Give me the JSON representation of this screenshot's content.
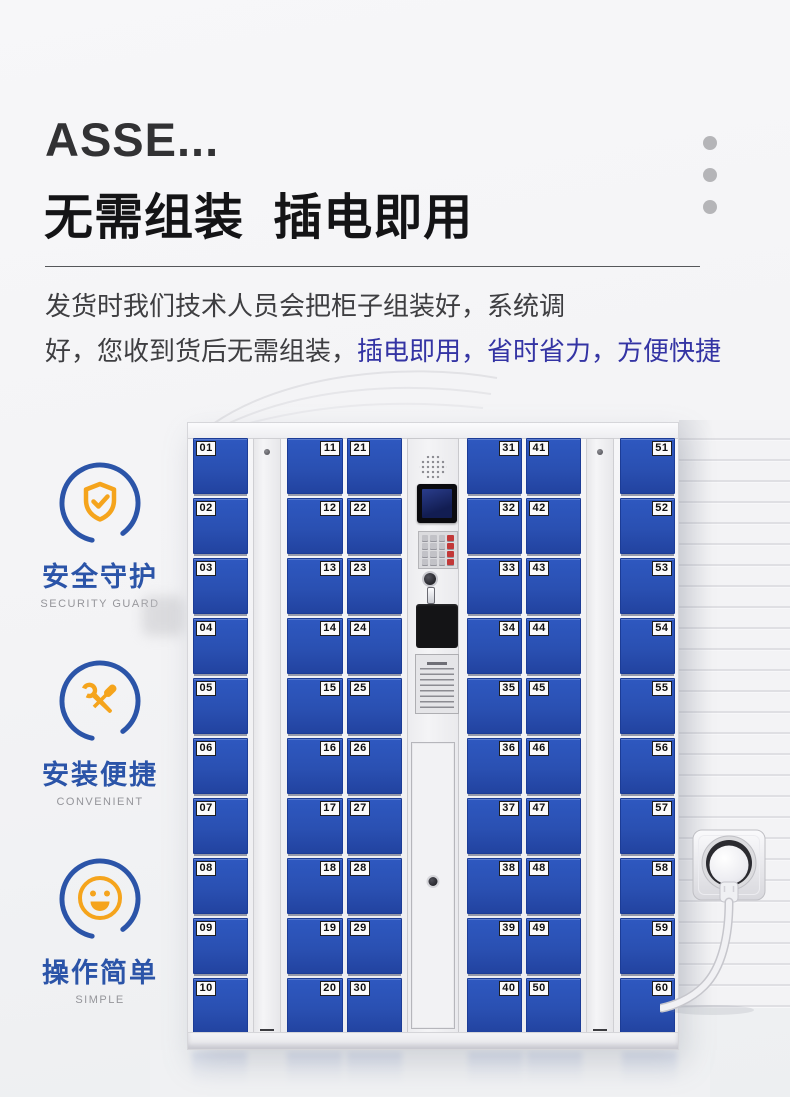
{
  "header": {
    "title_en": "ASSE...",
    "title_cn": "无需组装  插电即用",
    "description": {
      "line1": "发货时我们技术人员会把柜子组装好，系统调",
      "line2_dark": "好，您收到货后无需组装，",
      "line2_blue": "插电即用，省时省力，方便快捷"
    }
  },
  "features": [
    {
      "icon": "shield-check-icon",
      "label": "安全守护",
      "sublabel": "SECURITY GUARD"
    },
    {
      "icon": "tools-icon",
      "label": "安装便捷",
      "sublabel": "CONVENIENT"
    },
    {
      "icon": "smiley-icon",
      "label": "操作简单",
      "sublabel": "SIMPLE"
    }
  ],
  "locker": {
    "columns": [
      {
        "tag_side": "left",
        "doors": [
          "01",
          "02",
          "03",
          "04",
          "05",
          "06",
          "07",
          "08",
          "09",
          "10"
        ]
      },
      {
        "tag_side": "right",
        "doors": [
          "11",
          "12",
          "13",
          "14",
          "15",
          "16",
          "17",
          "18",
          "19",
          "20"
        ]
      },
      {
        "tag_side": "left",
        "doors": [
          "21",
          "22",
          "23",
          "24",
          "25",
          "26",
          "27",
          "28",
          "29",
          "30"
        ]
      },
      {
        "tag_side": "right",
        "doors": [
          "31",
          "32",
          "33",
          "34",
          "35",
          "36",
          "37",
          "38",
          "39",
          "40"
        ]
      },
      {
        "tag_side": "left",
        "doors": [
          "41",
          "42",
          "43",
          "44",
          "45",
          "46",
          "47",
          "48",
          "49",
          "50"
        ]
      },
      {
        "tag_side": "right",
        "doors": [
          "51",
          "52",
          "53",
          "54",
          "55",
          "56",
          "57",
          "58",
          "59",
          "60"
        ]
      }
    ],
    "control_panel_parts": [
      "speaker-grille",
      "display-screen",
      "keypad",
      "key-lock",
      "scanner-window",
      "notice-sticker",
      "service-door"
    ]
  },
  "colors": {
    "door_blue": "#2a50b4",
    "accent_blue": "#2b54a8",
    "accent_orange": "#f5a41c",
    "highlight_text_blue": "#3434a4",
    "dot_gray": "#b5b5b8"
  }
}
